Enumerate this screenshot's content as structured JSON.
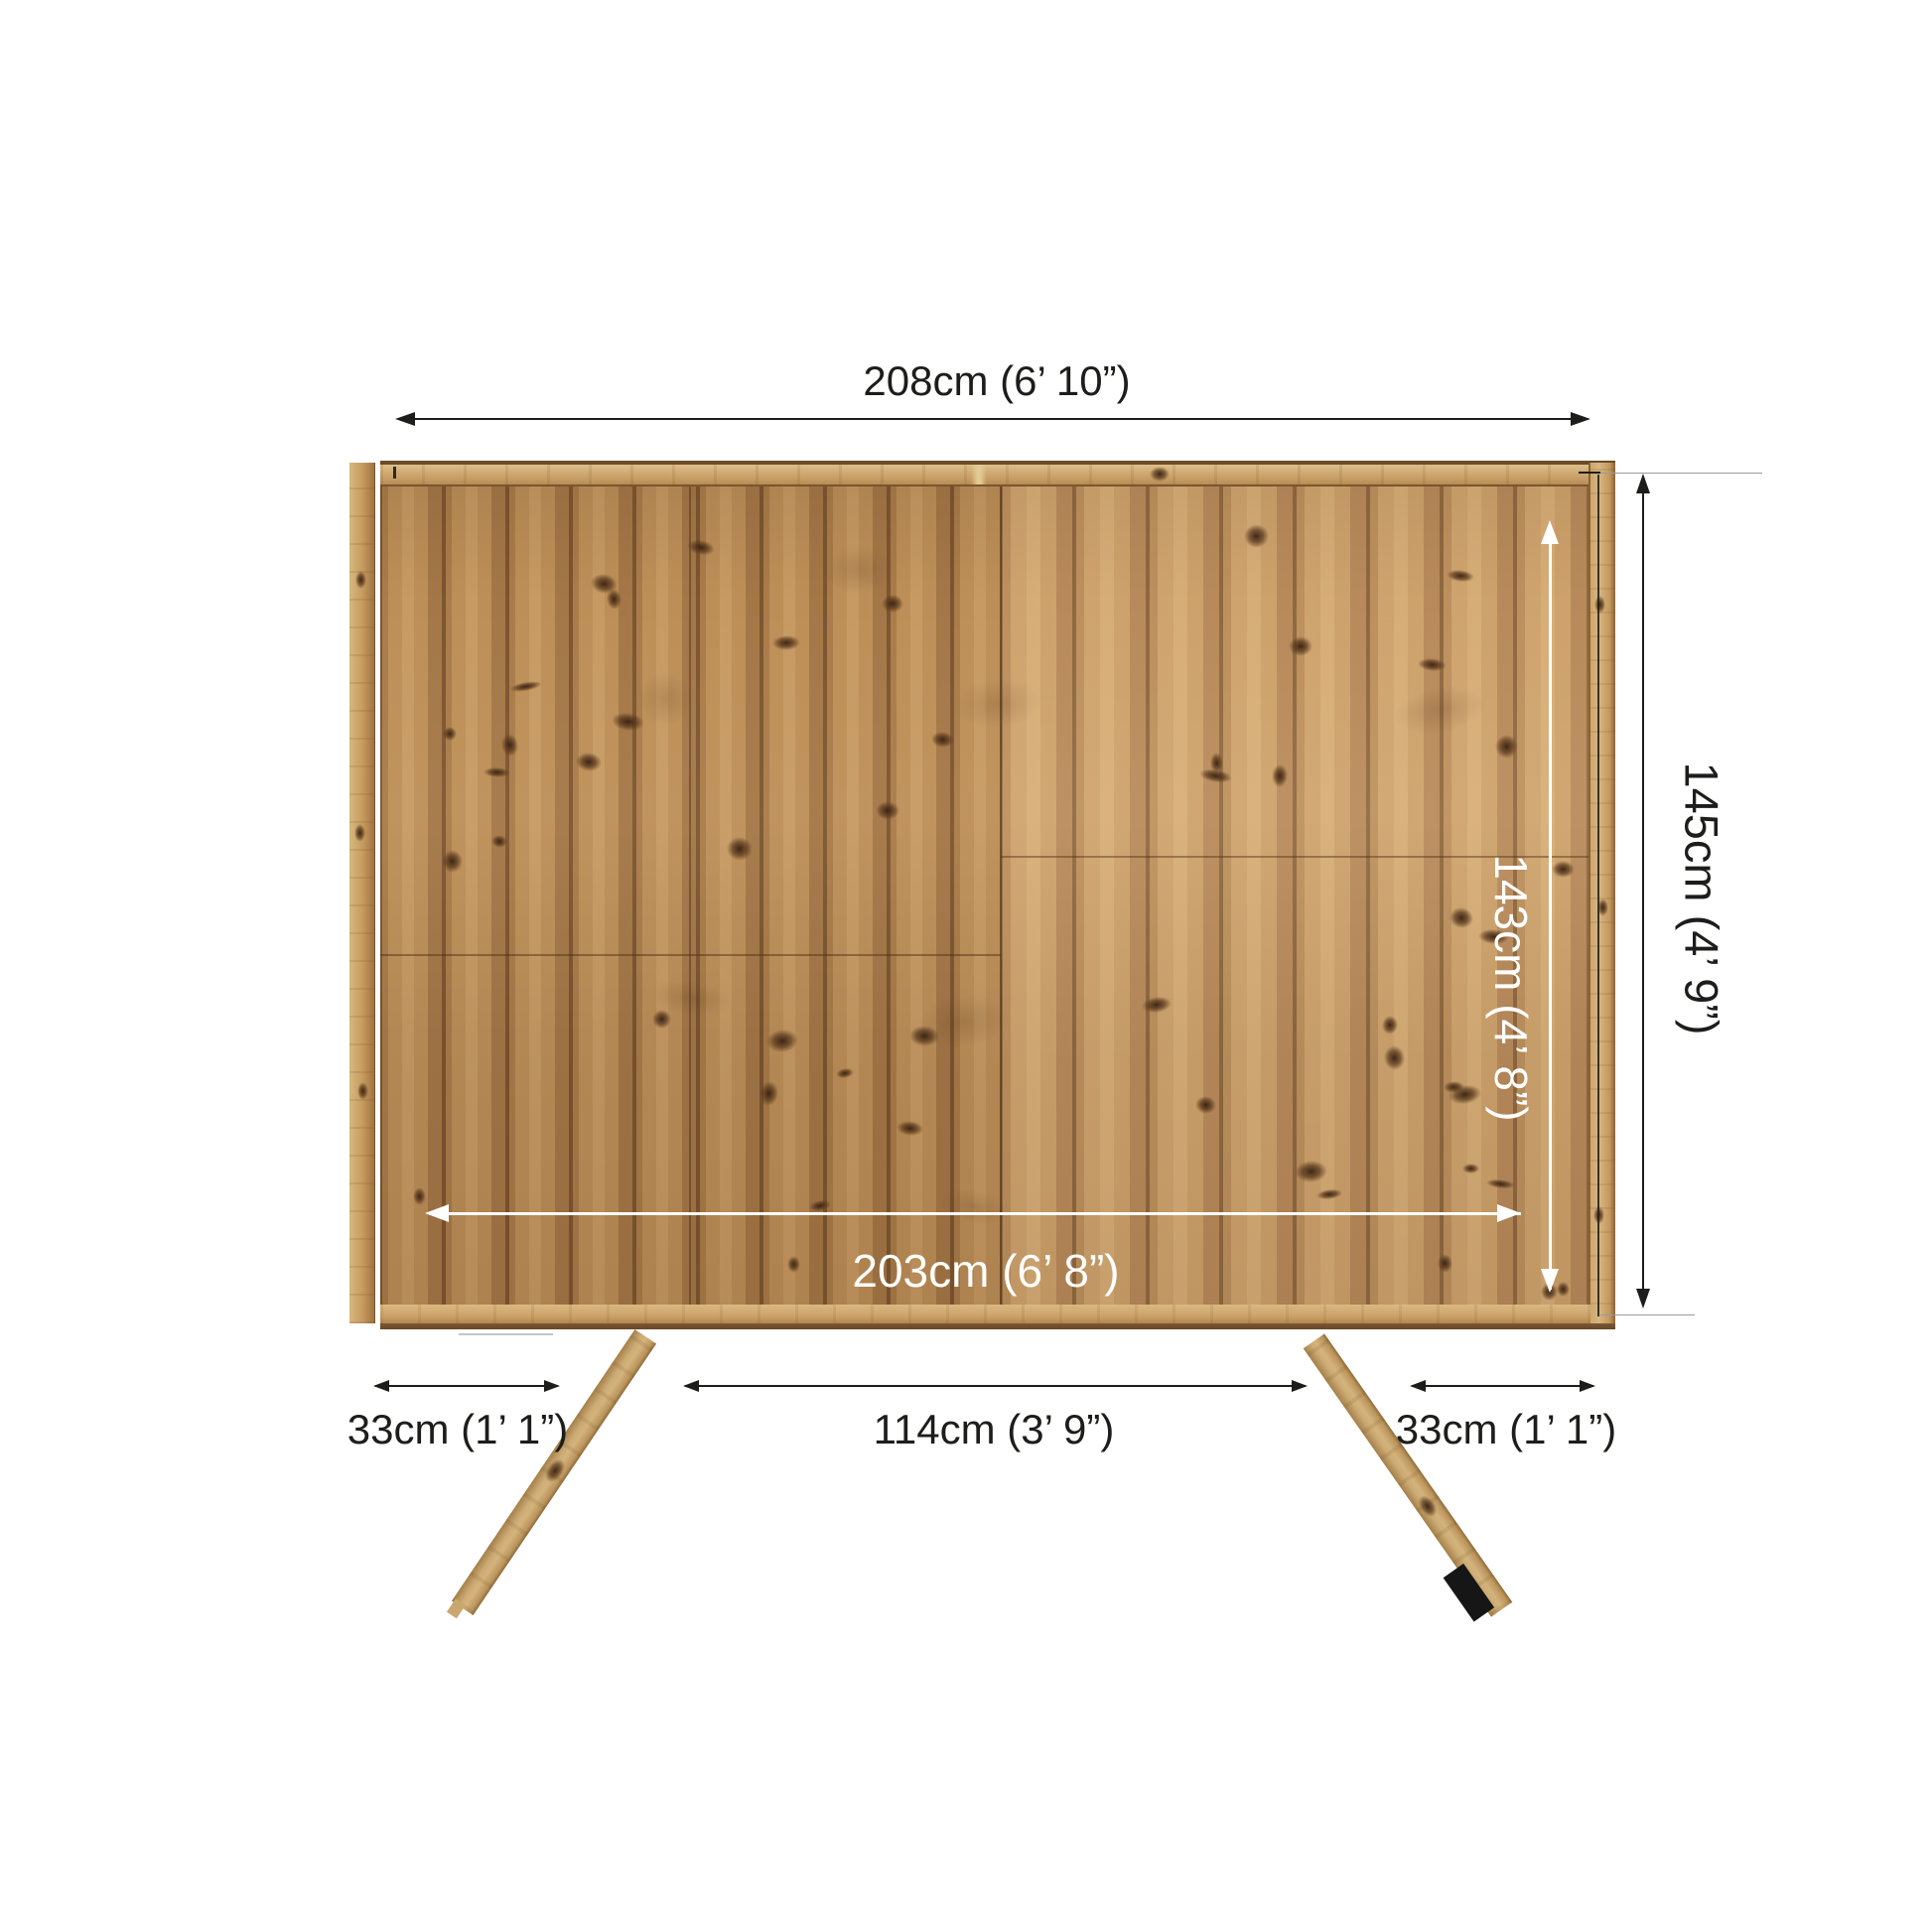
{
  "diagram": {
    "subject": "wooden pent shed rear panel with two support legs, front elevation with dimensions",
    "background": "#ffffff",
    "line_color": "#1d1d1b",
    "leader_color": "#9b9b9b",
    "white_dim_color": "#ffffff",
    "wood": {
      "plank_base": "#bd8f58",
      "plank_light": "#d2a770",
      "plank_dark": "#7d5530",
      "frame_light": "#d1ab74",
      "knot": "#5a3a20",
      "leg_foot": "#161616"
    },
    "dimensions": {
      "top_width": {
        "label": "208cm (6’ 10”)"
      },
      "outer_height": {
        "label": "145cm (4’ 9”)"
      },
      "inner_height": {
        "label": "143cm (4’ 8”)"
      },
      "inner_width": {
        "label": "203cm (6’ 8”)"
      },
      "left_offset": {
        "label": "33cm (1’ 1”)"
      },
      "center_span": {
        "label": "114cm (3’ 9”)"
      },
      "right_offset": {
        "label": "33cm (1’ 1”)"
      }
    }
  }
}
